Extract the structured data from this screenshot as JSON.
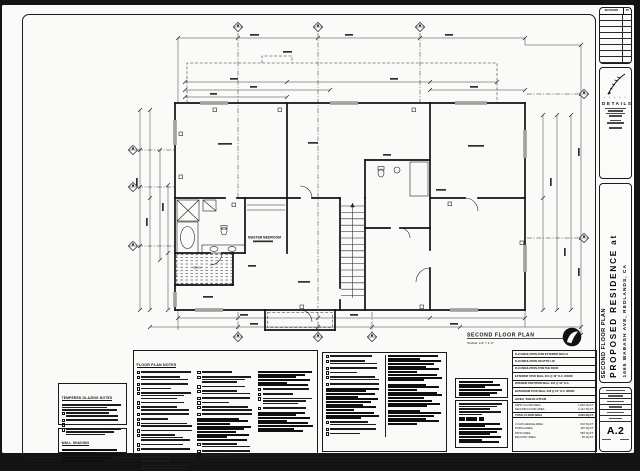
{
  "plan": {
    "title": "SECOND FLOOR PLAN",
    "scale": "SCALE: 1/4\" = 1'-0\"",
    "room_labels": {
      "master_bedroom": "MASTER BEDROOM",
      "deck": "DECK"
    }
  },
  "notes": {
    "floor_plan": {
      "title": "FLOOR PLAN NOTES"
    },
    "tempered": {
      "title": "TEMPERED GLAZING NOTES"
    },
    "wall_shading": {
      "title": "WALL SHADING"
    },
    "insulation": [
      "R-13 INSULATION AT/IN EXTERIOR WALLS",
      "R-19 INSULATION ON ATTIC LID",
      "R-13 INSULATION AT/IN THE ROOF"
    ],
    "wall_types": [
      "EXTERIOR STUD WALL 2X4 @ 16\" O.C. WOOD",
      "INTERIOR PARTITION WALL 2X4 @ 16\" O.C.",
      "BATHROOM STUD WALL 2X6 @ 16\" O.C. WOOD"
    ],
    "area_tabulation": {
      "title": "AREA TABULATION",
      "rows": [
        {
          "label": "FIRST FLOOR AREA",
          "value": "1,864 SQ.FT."
        },
        {
          "label": "SECOND FLOOR AREA",
          "value": "1,427 SQ.FT."
        },
        {
          "label": "TOTAL FLOOR AREA",
          "value": "3,291 SQ.FT."
        },
        {
          "label": "2 CAR GARAGE AREA",
          "value": "610 SQ.FT."
        },
        {
          "label": "PORCH AREA",
          "value": "187 SQ.FT."
        },
        {
          "label": "PATIO AREA",
          "value": "584 SQ.FT."
        },
        {
          "label": "BALCONY AREA",
          "value": "55 SQ.FT."
        }
      ]
    }
  },
  "titleblock": {
    "revisions": "REVISIONS",
    "by": "BY",
    "logo": "DETAILS",
    "plan_name": "SECOND FLOOR PLAN",
    "project_name": "PROPOSED RESIDENCE at",
    "project_address": "1665 WABASH AVE, REDLANDS, CA",
    "sheet_number": "A.2"
  }
}
